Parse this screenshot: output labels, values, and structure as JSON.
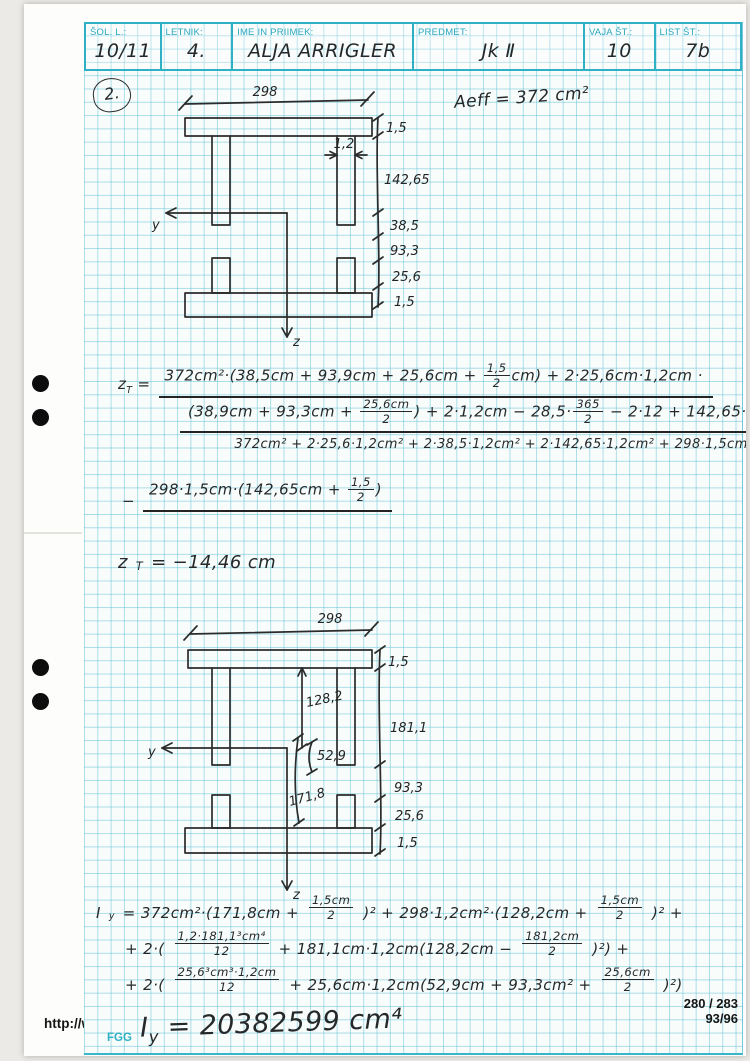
{
  "header": {
    "fields": [
      {
        "label": "ŠOL. L.:",
        "value": "10/11"
      },
      {
        "label": "LETNIK:",
        "value": "4."
      },
      {
        "label": "IME IN PRIIMEK:",
        "value": "ALJA ARRIGLER"
      },
      {
        "label": "PREDMET:",
        "value": "Jk Ⅱ"
      },
      {
        "label": "VAJA ŠT.:",
        "value": "10"
      },
      {
        "label": "LIST ŠT.:",
        "value": "7b"
      }
    ]
  },
  "annotations": {
    "section_number": "2.",
    "aeff": "Aeff = 372 cm²"
  },
  "diagram1": {
    "width_label": "298",
    "flange_thickness_top": "1,5",
    "web_thickness": "1,2",
    "web_height": "142,65",
    "dim_38_5": "38,5",
    "dim_93_3": "93,3",
    "dim_25_6": "25,6",
    "flange_thickness_bottom": "1,5",
    "axis_y": "y",
    "axis_z": "z"
  },
  "diagram2": {
    "width_label": "298",
    "flange_thickness_top": "1,5",
    "dim_128_2": "128,2",
    "dim_181_1": "181,1",
    "dim_52_9": "52,9",
    "dim_171_8": "171,8",
    "dim_93_3": "93,3",
    "dim_25_6": "25,6",
    "flange_thickness_bottom": "1,5",
    "axis_y": "y",
    "axis_z": "z"
  },
  "equations": {
    "zt": {
      "lhs": "z_T =",
      "numerator_line1": "372cm²·(38,5cm + 93,9cm + 25,6cm + {1,5|2}cm) + 2·25,6cm·1,2cm ·",
      "numerator_line2": "(38,9cm + 93,3cm + {25,6cm|2}) + 2·1,2cm − 28,5·{365|2} − 2·12 + 142,65·{142,65|2}",
      "trailing_minus": "−",
      "denominator": "372cm² + 2·25,6·1,2cm² + 2·38,5·1,2cm² + 2·142,65·1,2cm² + 298·1,5cm²",
      "line3_prefix": "−",
      "numerator_line3": "298·1,5cm·(142,65cm + {1,5|2})",
      "result": "z_T = −14,46 cm"
    },
    "iy": {
      "line1": "I_y = 372cm²·(171,8cm + {1,5cm|2})² + 298·1,2cm²·(128,2cm + {1,5cm|2})² +",
      "line2": "+ 2·({1,2·181,1³cm⁴|12} + 181,1cm·1,2cm(128,2cm − {181,2cm|2})²) +",
      "line3": "+ 2·({25,6³cm³·1,2cm|12} + 25,6cm·1,2cm(52,9cm + 93,3cm² + {25,6cm|2})²)",
      "result": "I_y = 20382599 cm⁴"
    }
  },
  "footer": {
    "url": "http://www.student-info.net/knjiznica",
    "org": "FGG",
    "page_number": "280 / 283",
    "page_number2": "93/96"
  }
}
